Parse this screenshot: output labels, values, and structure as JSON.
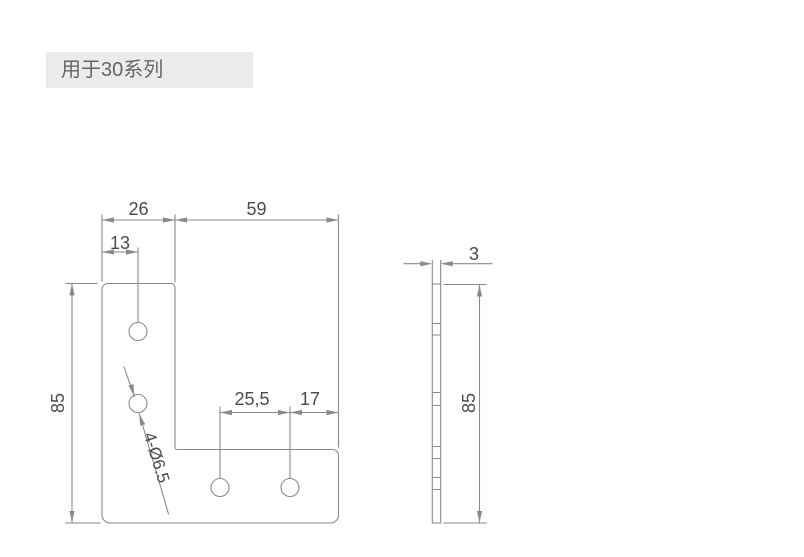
{
  "label": {
    "text": "用于30系列"
  },
  "drawing": {
    "front": {
      "hole_count": 4,
      "dims": {
        "arm_width": "26",
        "inner_width": "59",
        "hole_offset": "13",
        "height": "85",
        "hole_spacing": "25,5",
        "hole_to_edge": "17",
        "holes_callout": "4-Ø6.5"
      }
    },
    "side": {
      "dims": {
        "thickness": "3",
        "height": "85"
      }
    },
    "colors": {
      "line": "#8a8a8a",
      "dim_text": "#4a4a4a",
      "label_bg": "#ebebeb",
      "label_text": "#666666",
      "background": "#ffffff"
    }
  }
}
